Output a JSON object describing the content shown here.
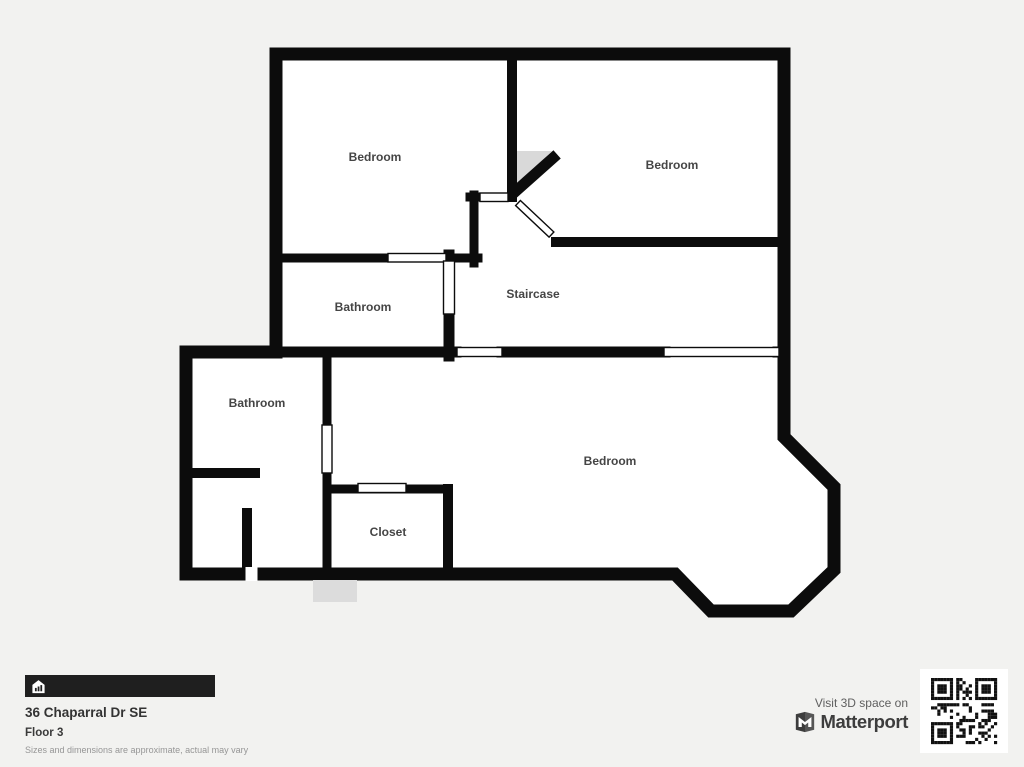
{
  "colors": {
    "background": "#f2f2f0",
    "wall": "#0c0c0c",
    "room_fill": "#ffffff",
    "shade": "#d9d9d9",
    "info_bar": "#1f1f1f",
    "qr": "#111111"
  },
  "plan": {
    "rooms": [
      {
        "name": "bedroom-top-left",
        "label": "Bedroom"
      },
      {
        "name": "bedroom-top-right",
        "label": "Bedroom"
      },
      {
        "name": "bathroom-upper",
        "label": "Bathroom"
      },
      {
        "name": "staircase",
        "label": "Staircase"
      },
      {
        "name": "bathroom-lower",
        "label": "Bathroom"
      },
      {
        "name": "bedroom-main",
        "label": "Bedroom"
      },
      {
        "name": "closet",
        "label": "Closet"
      }
    ]
  },
  "footer": {
    "address": "36 Chaparral Dr SE",
    "floor": "Floor 3",
    "disclaimer": "Sizes and dimensions are approximate, actual may vary"
  },
  "matterport": {
    "visit_text": "Visit 3D space on",
    "brand": "Matterport"
  },
  "icons": {
    "home": "home-icon",
    "matterport_mark": "matterport-logo-icon",
    "qr": "qr-code"
  }
}
